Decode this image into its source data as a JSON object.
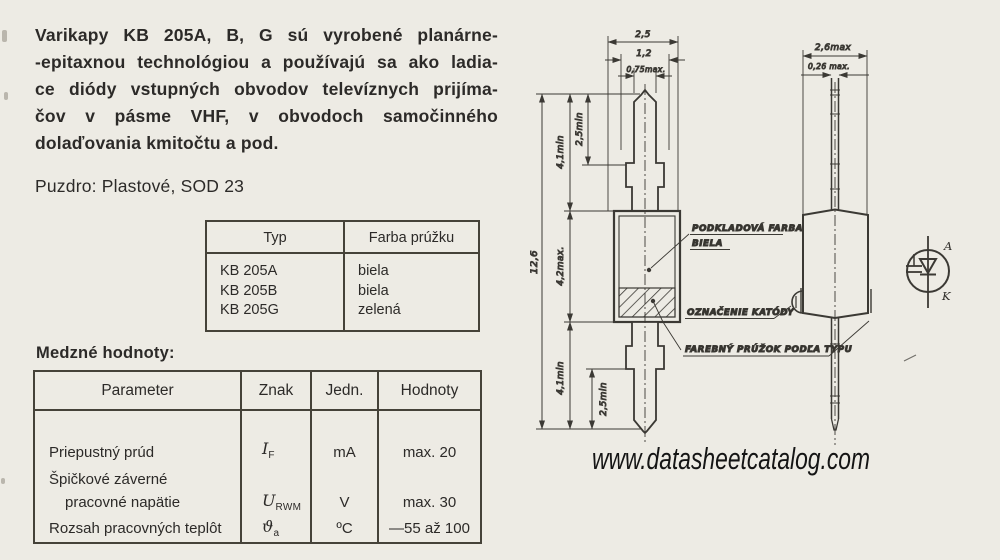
{
  "colors": {
    "paper": "#edebe4",
    "ink": "#2c2a28",
    "line": "#3b3934"
  },
  "intro": {
    "lines": [
      "Varikapy KB 205A, B, G sú vyrobené planárne-",
      "-epitaxnou technológiou a používajú sa ako ladia-",
      "ce diódy vstupných obvodov televíznych prijíma-",
      "čov v pásme VHF, v obvodoch samočinného",
      "dolaďovania kmitočtu a pod."
    ]
  },
  "package_line": "Puzdro: Plastové, SOD 23",
  "type_table": {
    "headers": [
      "Typ",
      "Farba prúžku"
    ],
    "rows": [
      [
        "KB 205A",
        "biela"
      ],
      [
        "KB 205B",
        "biela"
      ],
      [
        "KB 205G",
        "zelená"
      ]
    ]
  },
  "limits": {
    "title": "Medzné hodnoty:",
    "headers": [
      "Parameter",
      "Znak",
      "Jedn.",
      "Hodnoty"
    ],
    "rows": [
      {
        "param": "Priepustný prúd",
        "znak_main": "I",
        "znak_sub": "F",
        "unit": "mA",
        "value": "max. 20"
      },
      {
        "param_line1": "Špičkové záverné",
        "param_line2": "pracovné napätie",
        "znak_main": "U",
        "znak_sub": "RWM",
        "unit": "V",
        "value": "max. 30"
      },
      {
        "param": "Rozsah pracovných teplôt",
        "znak_main": "ϑ",
        "znak_sub": "a",
        "unit": "ºC",
        "value": "—55 až 100"
      }
    ]
  },
  "drawing": {
    "front": {
      "dim_25": "2,5",
      "dim_12": "1,2",
      "dim_075": "0,75max.",
      "dim_25min_top": "2,5min",
      "dim_41min_top": "4,1min",
      "dim_126": "12,6",
      "dim_42max": "4,2max.",
      "dim_41min_bot": "4,1min",
      "dim_25min_bot": "2,5min"
    },
    "side": {
      "dim_26max": "2,6max",
      "dim_026max": "0,26 max."
    },
    "labels": {
      "base_paint_1": "PODKLADOVÁ FARBA",
      "base_paint_2": "BIELA",
      "cathode_mark": "OZNAČENIE KATÓDY",
      "color_stripe": "FAREBNÝ PRÚŽOK PODĽA TYPU"
    },
    "symbol": {
      "anode": "A",
      "cathode": "K"
    }
  },
  "watermark": "www.datasheetcatalog.com"
}
